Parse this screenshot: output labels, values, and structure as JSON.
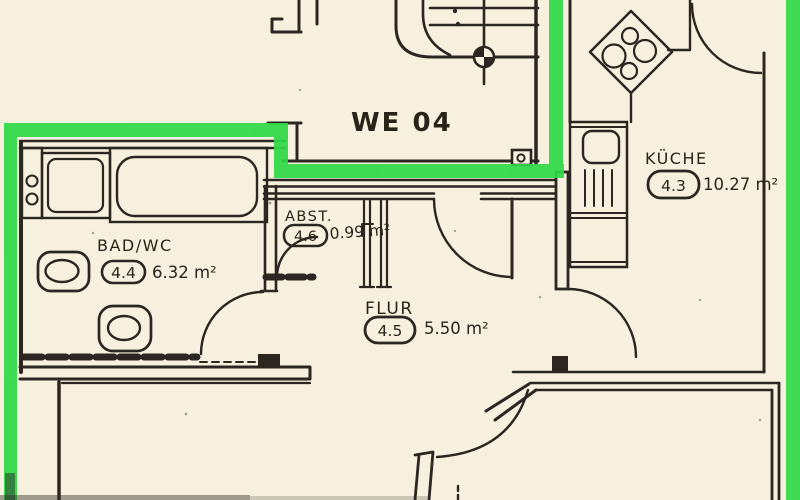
{
  "plan": {
    "unit_label": "WE 04",
    "rooms": [
      {
        "id": "bad",
        "name": "BAD/WC",
        "number": "4.4",
        "area": "6.32 m²"
      },
      {
        "id": "abst",
        "name": "ABST.",
        "number": "4.6",
        "area": "0.99 m²"
      },
      {
        "id": "flur",
        "name": "FLUR",
        "number": "4.5",
        "area": "5.50 m²"
      },
      {
        "id": "kueche",
        "name": "KÜCHE",
        "number": "4.3",
        "area": "10.27 m²"
      }
    ],
    "symbols": {
      "stairwell": "stairwell-with-datum-circle",
      "bathtub": "bathtub-icon",
      "washing_machine": "washing-machine-icon",
      "toilet": "toilet-icon",
      "bidet": "bidet-icon",
      "stove": "stove-4-burner-icon",
      "sink": "kitchen-sink-icon"
    },
    "colors": {
      "highlight": "#2fd948",
      "label_red": "#d5281f",
      "ink": "#2b2620",
      "paper": "#f7f0df"
    }
  }
}
